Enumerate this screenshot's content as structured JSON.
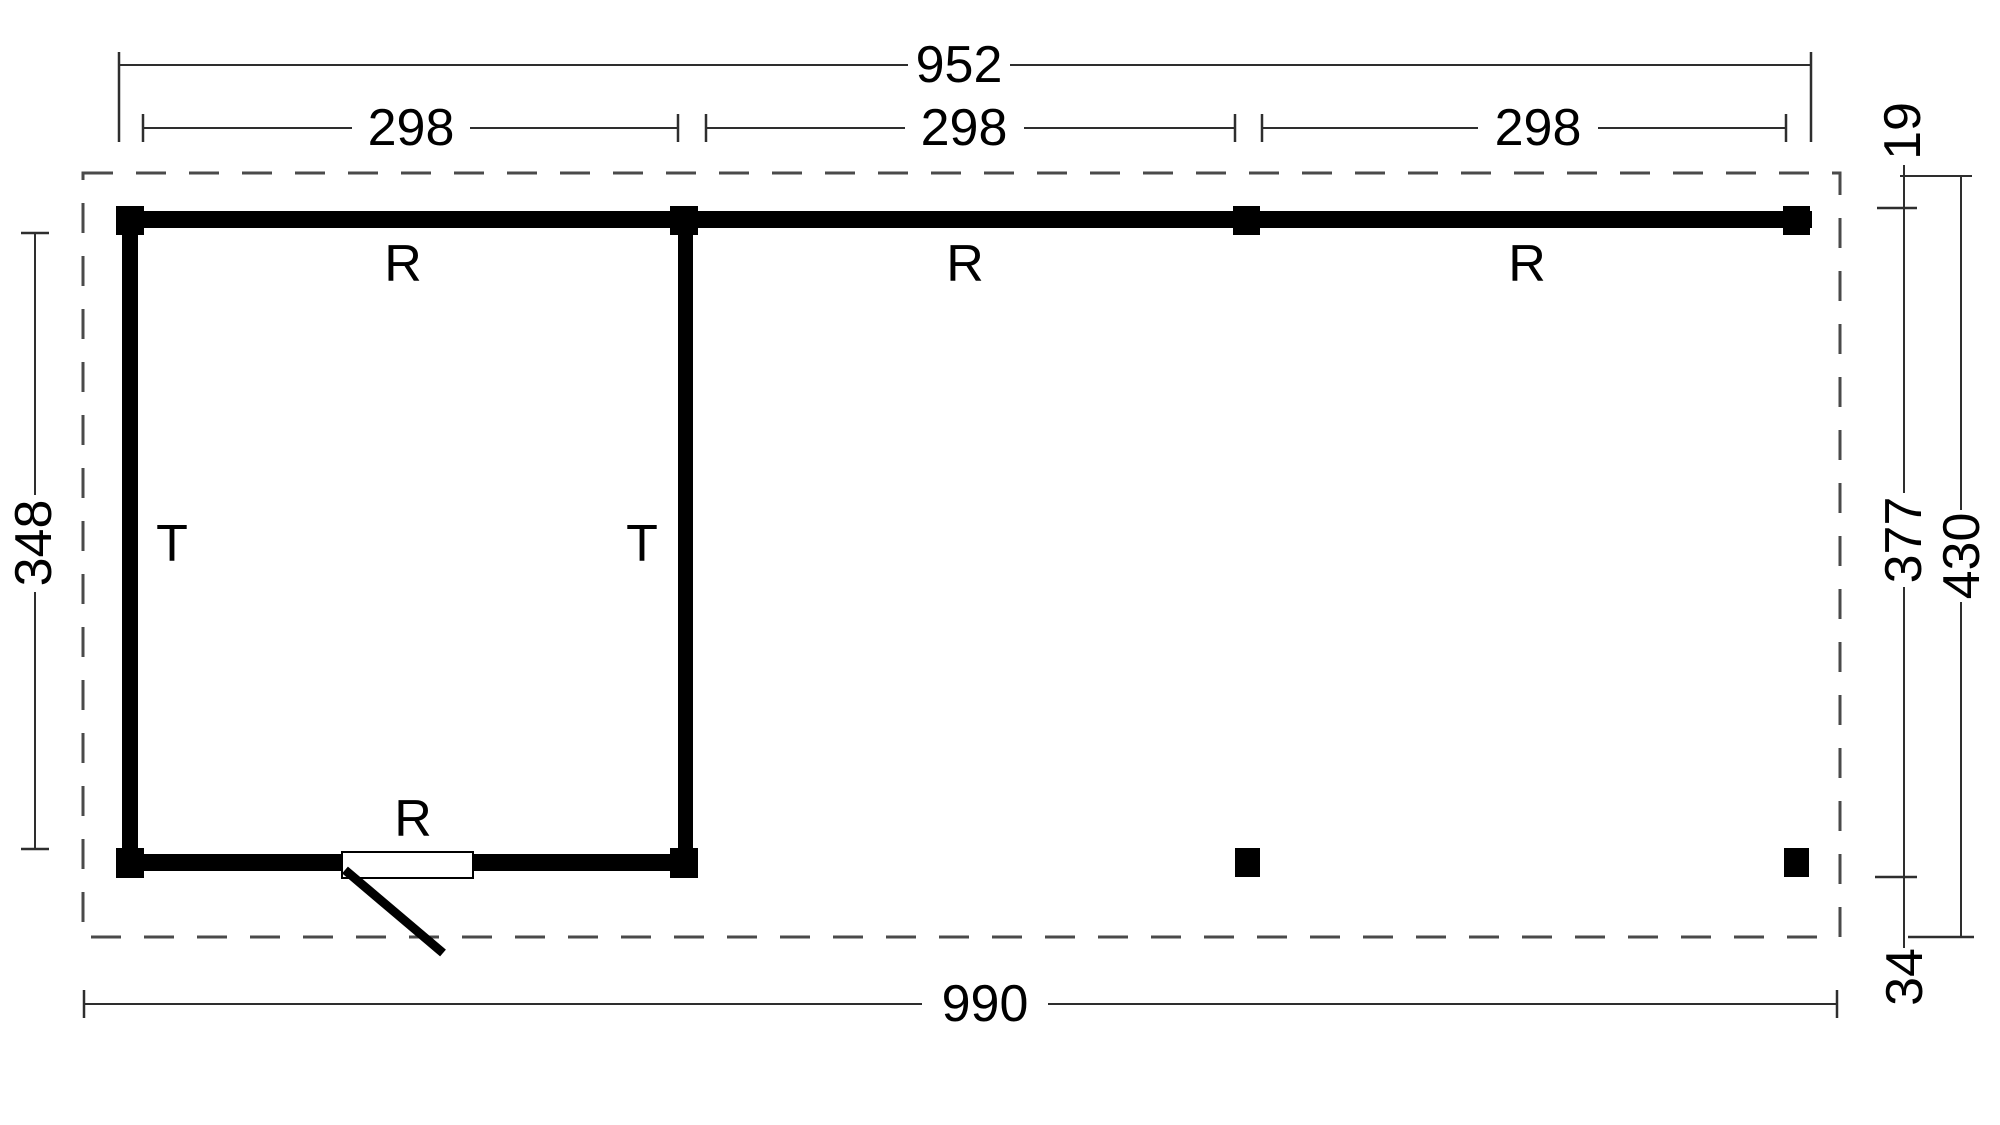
{
  "colors": {
    "background": "#ffffff",
    "ink": "#000000",
    "dimension_line": "#2e2e2e",
    "dashed_outline": "#4a4a4a"
  },
  "dimensions": {
    "top_total": "952",
    "top_spans": [
      "298",
      "298",
      "298"
    ],
    "left_height": "348",
    "right_overhang_top": "19",
    "right_span": "377",
    "right_total": "430",
    "right_overhang_bottom": "34",
    "bottom_total": "990"
  },
  "labels": {
    "beam_left": "R",
    "beam_middle": "R",
    "beam_right": "R",
    "room_bottom_beam": "R",
    "wall_left": "T",
    "wall_middle": "T"
  }
}
